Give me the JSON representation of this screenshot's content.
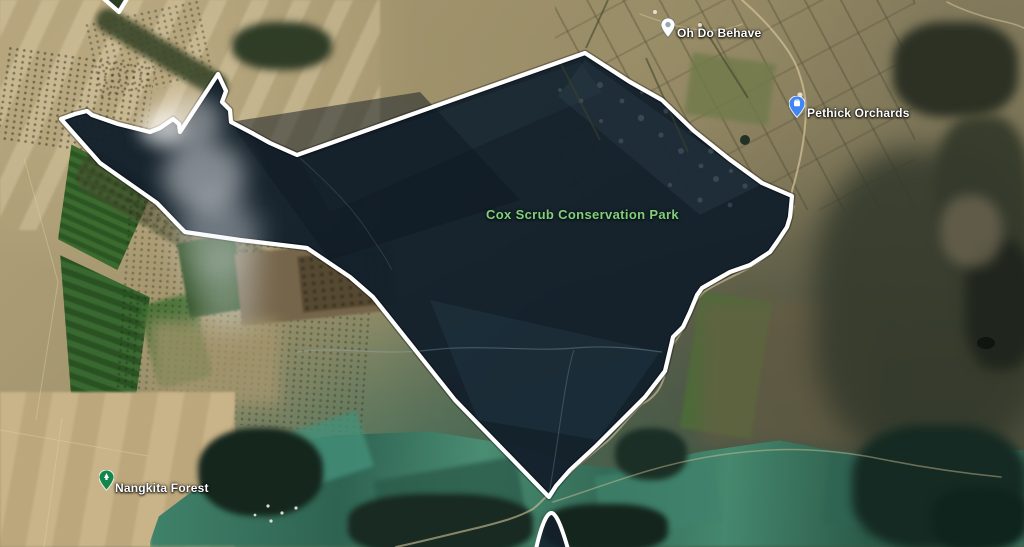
{
  "map": {
    "view": "satellite",
    "area_label": {
      "text": "Cox Scrub Conservation Park"
    },
    "places": [
      {
        "label": "Oh Do Behave",
        "pin": "poi-pin-white"
      },
      {
        "label": "Pethick Orchards",
        "pin": "place-pin-blue"
      },
      {
        "label": "Nangkita Forest",
        "pin": "park-pin-green"
      }
    ],
    "boundary": {
      "name": "park-boundary",
      "color": "#ffffff"
    }
  },
  "theme": {
    "park-label-green": "#86cb80",
    "label-white": "#ffffff",
    "pin-blue": "#4285f4",
    "pin-green": "#13874b",
    "boundary-white": "#ffffff",
    "park-fill": "#13202b"
  }
}
